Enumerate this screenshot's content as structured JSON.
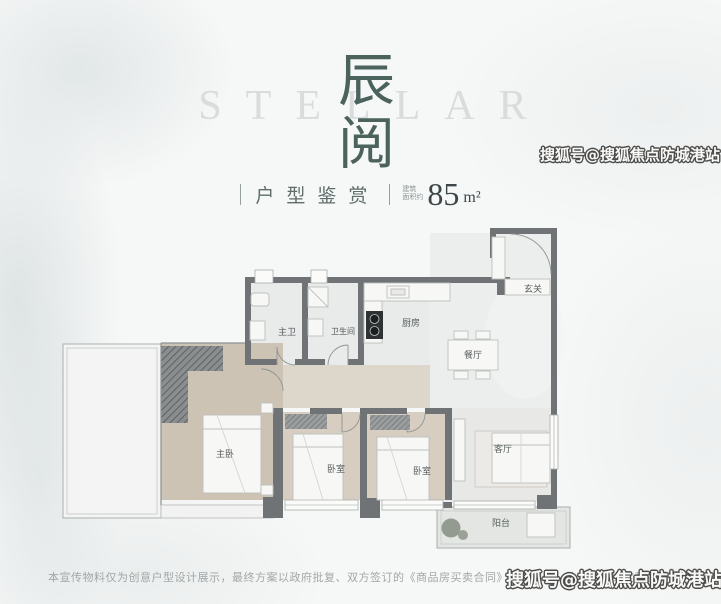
{
  "page": {
    "watermark_text": "搜狐号@搜狐焦点防城港站",
    "disclaimer": "本宣传物料仅为创意户型设计展示，最终方案以政府批复、双方签订的《商品房买卖合同》及其附件、补充协议约定和实际交付为准"
  },
  "header": {
    "background_word": "STELLAR",
    "title_chars": [
      "辰",
      "阅"
    ],
    "subtitle": "户型鉴赏",
    "area_prefix_line1": "建筑",
    "area_prefix_line2": "面积约",
    "area_value": "85",
    "area_unit": "m²"
  },
  "floorplan": {
    "rooms": [
      {
        "id": "entry",
        "label": "玄关"
      },
      {
        "id": "master-bath",
        "label": "主卫"
      },
      {
        "id": "bathroom",
        "label": "卫生间"
      },
      {
        "id": "kitchen",
        "label": "厨房"
      },
      {
        "id": "dining",
        "label": "餐厅"
      },
      {
        "id": "master-bedroom",
        "label": "主卧"
      },
      {
        "id": "bedroom-a",
        "label": "卧室"
      },
      {
        "id": "bedroom-b",
        "label": "卧室"
      },
      {
        "id": "living",
        "label": "客厅"
      },
      {
        "id": "balcony",
        "label": "阳台"
      }
    ]
  },
  "colors": {
    "title": "#4b625d",
    "stellar_word": "#d8dcdc",
    "wall": "#6f7375",
    "room_gray": "#e9eaea",
    "wood_floor": "#cdc3b4",
    "watermark_fill": "#f9f9f7",
    "watermark_outline": "#4c4c4a"
  }
}
